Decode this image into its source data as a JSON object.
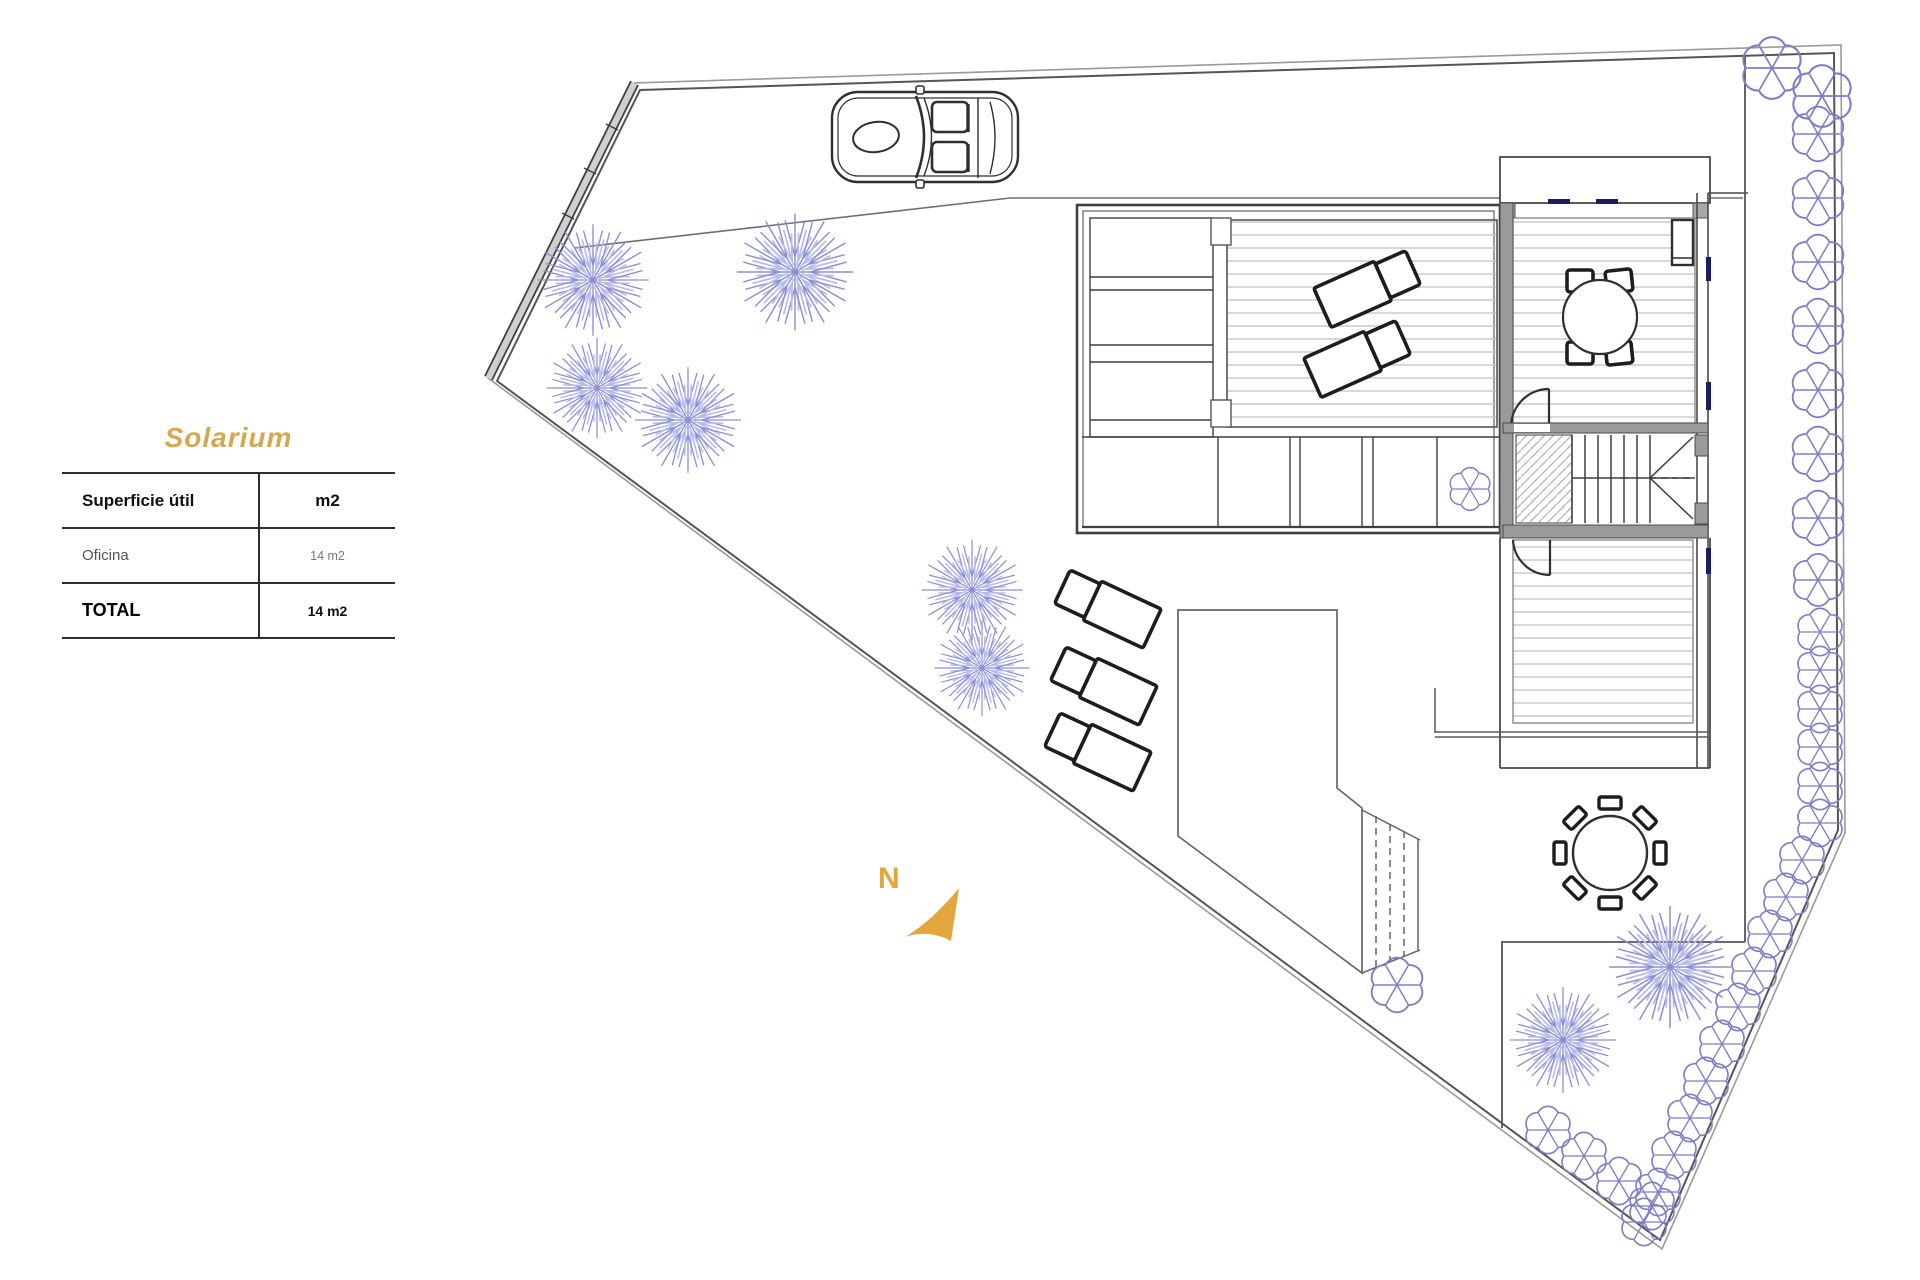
{
  "page": {
    "background": "#ffffff"
  },
  "legend": {
    "title": "Solarium",
    "table": {
      "header": [
        "Superficie útil",
        "m2"
      ],
      "rows": [
        [
          "Oficina",
          "14 m2"
        ]
      ],
      "total": [
        "TOTAL",
        "14 m2"
      ]
    }
  },
  "compass": {
    "label": "N"
  },
  "plan": {
    "colors": {
      "accent_gold": "#D4A94F",
      "compass_gold": "#E2A63D",
      "wall_dark": "#3f3f3f",
      "wall_fill": "#9a9a9a",
      "thin_line": "#6e6e6e",
      "boundary": "#8a8a8a",
      "deck_hatch": "#c6c6c6",
      "vegetation": "#8b8fd4",
      "vegetation_light": "#b9bce8",
      "shrub": "#7b7fc5",
      "window_marker": "#1b1b66"
    },
    "trees": [
      [
        593,
        280,
        1.05
      ],
      [
        795,
        272,
        1.1
      ],
      [
        597,
        388,
        0.95
      ],
      [
        688,
        420,
        1.0
      ],
      [
        972,
        590,
        0.95
      ],
      [
        982,
        668,
        0.9
      ],
      [
        1670,
        967,
        1.15
      ],
      [
        1563,
        1040,
        1.0
      ]
    ],
    "shrubs": [
      [
        1470,
        489,
        0.9
      ],
      [
        1397,
        985,
        1.15
      ]
    ],
    "hedge": [
      [
        1772,
        68,
        1.3
      ],
      [
        1822,
        96,
        1.3
      ],
      [
        1818,
        134,
        1.15
      ],
      [
        1818,
        198,
        1.15
      ],
      [
        1818,
        262,
        1.15
      ],
      [
        1818,
        326,
        1.15
      ],
      [
        1818,
        390,
        1.15
      ],
      [
        1818,
        454,
        1.15
      ],
      [
        1818,
        518,
        1.15
      ],
      [
        1818,
        580,
        1.1
      ],
      [
        1820,
        632,
        1.0
      ],
      [
        1820,
        670,
        1.0
      ],
      [
        1820,
        709,
        1.0
      ],
      [
        1820,
        747,
        1.0
      ],
      [
        1820,
        786,
        1.0
      ],
      [
        1820,
        823,
        1.0
      ],
      [
        1802,
        860,
        1.0
      ],
      [
        1786,
        897,
        1.0
      ],
      [
        1770,
        934,
        1.0
      ],
      [
        1754,
        971,
        1.0
      ],
      [
        1738,
        1007,
        1.0
      ],
      [
        1722,
        1044,
        1.0
      ],
      [
        1706,
        1081,
        1.0
      ],
      [
        1690,
        1118,
        1.0
      ],
      [
        1674,
        1155,
        1.0
      ],
      [
        1658,
        1192,
        1.0
      ],
      [
        1644,
        1222,
        1.0
      ],
      [
        1548,
        1130,
        1.0
      ],
      [
        1584,
        1156,
        1.0
      ],
      [
        1619,
        1181,
        1.0
      ],
      [
        1652,
        1206,
        1.0
      ]
    ],
    "loungers": [
      "translate(1368,287) rotate(-24) scale(-1,1) translate(-50,-21)",
      "translate(1358,357) rotate(-24) scale(-1,1) translate(-50,-21)",
      "translate(1107,607) rotate(25) translate(-50,-21)",
      "translate(1103,684) rotate(25) translate(-50,-21)",
      "translate(1097,750) rotate(25) translate(-50,-21)"
    ]
  }
}
